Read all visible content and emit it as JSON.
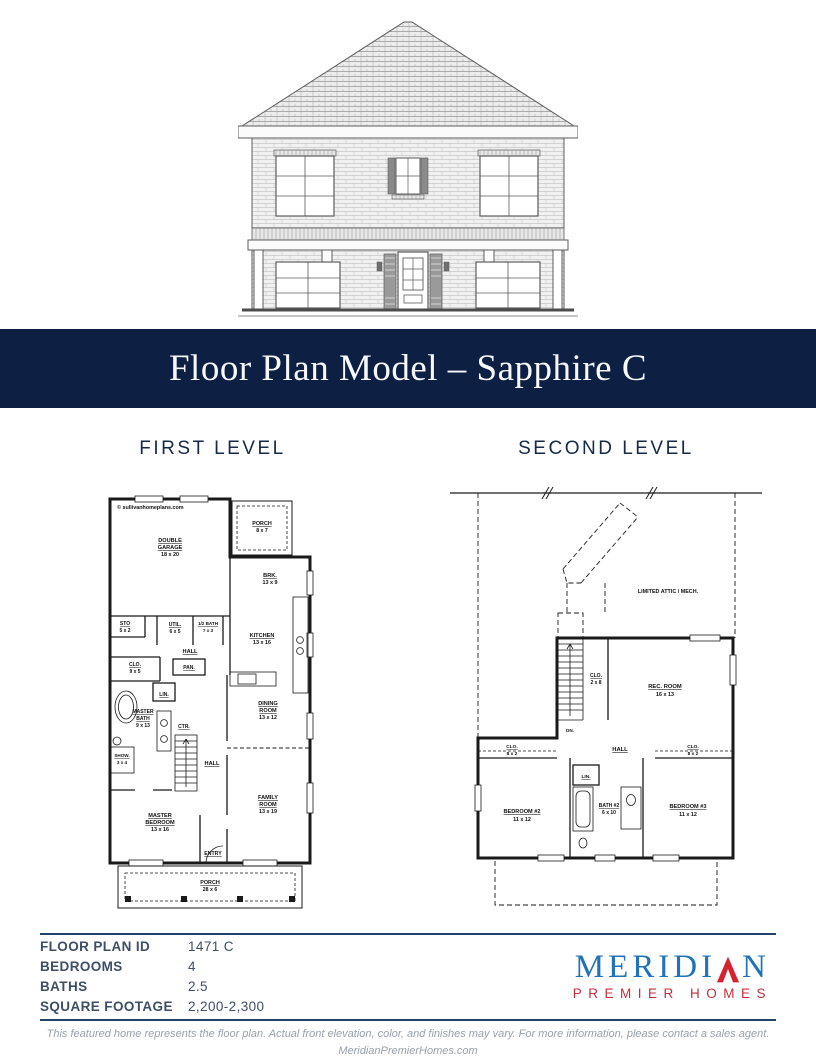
{
  "banner": {
    "title": "Floor Plan Model – Sapphire C",
    "background": "#0d1f42"
  },
  "first_level": {
    "heading": "FIRST LEVEL",
    "watermark": "© sullivanhomeplans.com",
    "rooms": {
      "garage": {
        "n1": "DOUBLE",
        "n2": "GARAGE",
        "d": "18 x 20"
      },
      "porch_rear": {
        "n1": "PORCH",
        "d": "8 x 7"
      },
      "brk": {
        "n1": "BRK.",
        "d": "13 x 9"
      },
      "sto": {
        "n1": "STO",
        "d": "5 x 2"
      },
      "util": {
        "n1": "UTIL.",
        "d": "6 x 5"
      },
      "half_bath": {
        "n1": "1/2 BATH",
        "d": "7 x 3"
      },
      "hall_upper": {
        "n1": "HALL"
      },
      "kitchen": {
        "n1": "KITCHEN",
        "d": "13 x 16"
      },
      "clo": {
        "n1": "CLO.",
        "d": "9 x 5"
      },
      "pan": {
        "n1": "PAN."
      },
      "lin": {
        "n1": "LIN."
      },
      "master_bath": {
        "n1": "MASTER",
        "n2": "BATH",
        "d": "9 x 13"
      },
      "ctr": {
        "n1": "CTR."
      },
      "shower": {
        "n1": "SHOW.",
        "d": "3 x 4"
      },
      "dining": {
        "n1": "DINING",
        "n2": "ROOM",
        "d": "13 x 12"
      },
      "hall_lower": {
        "n1": "HALL"
      },
      "master_bedroom": {
        "n1": "MASTER",
        "n2": "BEDROOM",
        "d": "13 x 16"
      },
      "entry": {
        "n1": "ENTRY"
      },
      "family": {
        "n1": "FAMILY",
        "n2": "ROOM",
        "d": "13 x 19"
      },
      "porch_front": {
        "n1": "PORCH",
        "d": "28 x 6"
      }
    }
  },
  "second_level": {
    "heading": "SECOND LEVEL",
    "attic_label": "LIMITED ATTIC / MECH.",
    "rooms": {
      "clo_stair": {
        "n1": "CLO.",
        "d": "2 x 8"
      },
      "rec_room": {
        "n1": "REC. ROOM",
        "d": "16 x 13"
      },
      "dn": {
        "n1": "DN."
      },
      "clo_left": {
        "n1": "CLO.",
        "d": "8 x 2"
      },
      "hall": {
        "n1": "HALL"
      },
      "clo_right": {
        "n1": "CLO.",
        "d": "8 x 2"
      },
      "lin": {
        "n1": "LIN."
      },
      "bedroom2": {
        "n1": "BEDROOM #2",
        "d": "11 x 12"
      },
      "bath2": {
        "n1": "BATH #2",
        "d": "6 x 10"
      },
      "bedroom3": {
        "n1": "BEDROOM #3",
        "d": "11 x 12"
      }
    }
  },
  "details": {
    "rows": [
      {
        "label": "FLOOR PLAN ID",
        "value": "1471 C"
      },
      {
        "label": "BEDROOMS",
        "value": "4"
      },
      {
        "label": "BATHS",
        "value": "2.5"
      },
      {
        "label": "SQUARE FOOTAGE",
        "value": "2,200-2,300"
      }
    ]
  },
  "logo": {
    "name_start": "MERIDI",
    "name_end": "N",
    "tagline": "PREMIER HOMES",
    "blue": "#2173b9",
    "red": "#d5222e"
  },
  "footer": {
    "disclaimer": "This featured home represents the floor plan. Actual front elevation, color, and finishes may vary. For more information, please contact a sales agent.",
    "website": "MeridianPremierHomes.com"
  }
}
